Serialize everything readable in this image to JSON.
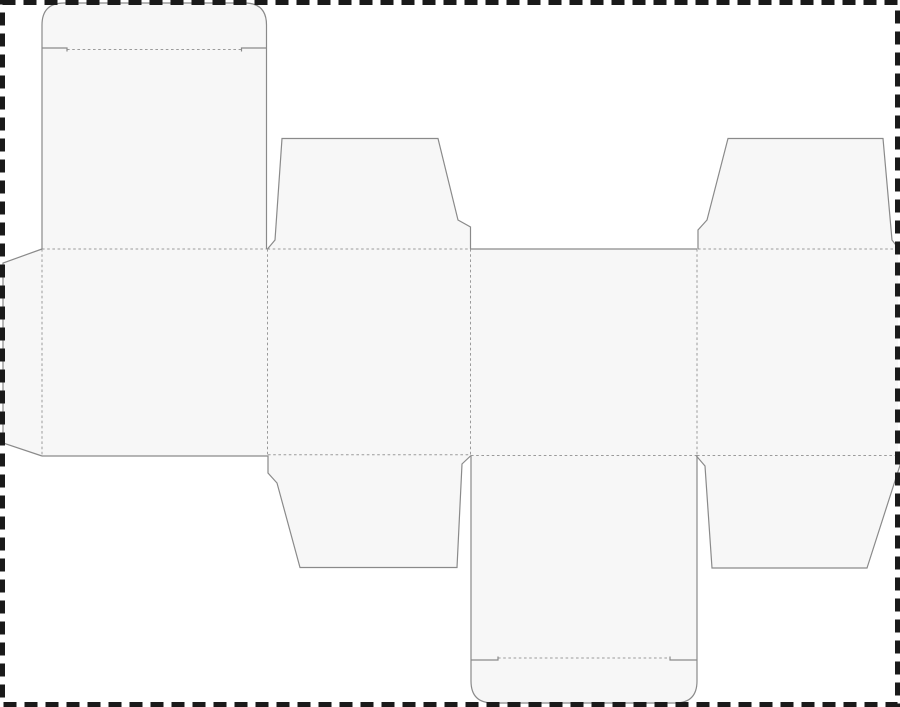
{
  "page": {
    "title": "box-dieline-template",
    "description": "Die-cut template (net) for a tuck-top carton: glue tab, four body panels, lid panel with rounded tuck flap, four dust flaps, bottom panel with rounded tuck flap. No text content."
  },
  "drawing": {
    "width": 900,
    "height": 707,
    "colors": {
      "background": "#ffffff",
      "panel_fill": "#f7f7f7",
      "cut_line": "#8a8a8a",
      "fold_line": "#9b9b9b",
      "page_border": "#1a1a1a"
    },
    "stroke_widths": {
      "cut": 1.2,
      "fold": 1,
      "border": 5
    },
    "fold_dash": "2.6 2.6",
    "page_border": {
      "x": 2.5,
      "y": 2.5,
      "width": 895,
      "height": 702,
      "dash": "13 8"
    },
    "fills": [
      {
        "name": "lid-panel-and-tuck-fill",
        "d": "M42,249 L42,25 Q42,3 64,3 L244.5,3 Q266.5,3 266.5,25 L266.5,249 Z"
      },
      {
        "name": "glue-tab-fill",
        "d": "M42,249 L3,263 L3,443 L42,456 Z"
      },
      {
        "name": "body-panels-band-fill",
        "d": "M42,249 L898,249 L898,456 L42,456 Z"
      },
      {
        "name": "top-dust-flap-left-fill",
        "d": "M267.5,249 L275,240 L282,138.5 L438,138.5 L458,220 L470.5,227 L470.5,249 Z"
      },
      {
        "name": "top-dust-flap-right-fill",
        "d": "M698,249 L698,230 L707,220 L728,138.5 L883,138.5 L892,240 L899,249 Z"
      },
      {
        "name": "bottom-dust-flap-left-fill",
        "d": "M268,455.5 L268,473 L277,483 L300,567.5 L457,567.5 L462,464 L471,455.5 Z"
      },
      {
        "name": "bottom-dust-flap-right-fill",
        "d": "M696,455.5 L705,466 L712,568 L867,568 L903,456 Z"
      },
      {
        "name": "bottom-panel-and-tuck-fill",
        "d": "M471,455.5 L697,455.5 L697,681 Q697,703 675,703 L493,703 Q471,703 471,681 Z"
      }
    ],
    "cuts": [
      {
        "name": "lid-tuck-outline-cut",
        "d": "M42,48 L42,25 Q42,3 64,3 L244.5,3 Q266.5,3 266.5,25 L266.5,48"
      },
      {
        "name": "lid-tuck-shoulder-left-cut",
        "d": "M42,48 L67,48 L67,51.5"
      },
      {
        "name": "lid-tuck-shoulder-right-cut",
        "d": "M266.5,48 L241.5,48 L241.5,51.5"
      },
      {
        "name": "lid-panel-left-edge-cut",
        "d": "M42,48 L42,249"
      },
      {
        "name": "lid-panel-right-edge-cut",
        "d": "M266.5,48 L266.5,249"
      },
      {
        "name": "glue-tab-outline-cut",
        "d": "M42,249 L3,263 L3,443 L42,456"
      },
      {
        "name": "front-panel-bottom-edge-cut",
        "d": "M42,456 L268,456"
      },
      {
        "name": "top-dust-flap-left-outline-cut",
        "d": "M267.5,249 L275,240 L282,138.5 L438,138.5 L458,220 L470.5,227 L470.5,249"
      },
      {
        "name": "back-panel-top-edge-cut",
        "d": "M470.5,249 L697,249"
      },
      {
        "name": "top-dust-flap-right-outline-cut",
        "d": "M698,249 L698,230 L707,220 L728,138.5 L883,138.5 L892,240 L899,249"
      },
      {
        "name": "bottom-dust-flap-left-outline-cut",
        "d": "M268,455.5 L268,473 L277,483 L300,567.5 L457,567.5 L462,464 L471,455.5"
      },
      {
        "name": "bottom-dust-flap-right-outline-cut",
        "d": "M696,455.5 L705,466 L712,568 L867,568 L903,456"
      },
      {
        "name": "bottom-panel-left-edge-cut",
        "d": "M471,455.5 L471,660"
      },
      {
        "name": "bottom-panel-right-edge-cut",
        "d": "M697,455.5 L697,660"
      },
      {
        "name": "bottom-tuck-shoulder-left-cut",
        "d": "M471,660 L498,660 L498,656.5"
      },
      {
        "name": "bottom-tuck-shoulder-right-cut",
        "d": "M697,660 L670,660 L670,656.5"
      },
      {
        "name": "bottom-tuck-outline-cut",
        "d": "M471,660 L471,681 Q471,703 493,703 L675,703 Q697,703 697,681 L697,660"
      }
    ],
    "folds": [
      {
        "name": "lid-tuck-fold",
        "d": "M67,49.5 L241.5,49.5"
      },
      {
        "name": "lid-to-front-panel-fold",
        "d": "M42,249 L267.5,249"
      },
      {
        "name": "top-dust-flap-left-fold",
        "d": "M267.5,249 L470.5,249"
      },
      {
        "name": "top-dust-flap-right-fold",
        "d": "M698,249 L897,249"
      },
      {
        "name": "bottom-dust-flap-left-fold",
        "d": "M268,454.8 L471,454.8"
      },
      {
        "name": "back-panel-to-bottom-panel-fold",
        "d": "M471,455.5 L697,455.5"
      },
      {
        "name": "bottom-dust-flap-right-fold",
        "d": "M697,455.5 L897,455.5"
      },
      {
        "name": "glue-tab-fold",
        "d": "M42,249 L42,456"
      },
      {
        "name": "panel-1-2-fold",
        "d": "M267.5,249 L267.5,455"
      },
      {
        "name": "panel-2-3-fold",
        "d": "M470.5,249 L470.5,455"
      },
      {
        "name": "panel-3-4-fold",
        "d": "M697,249 L697,455.5"
      },
      {
        "name": "bottom-tuck-fold",
        "d": "M498,658 L670,658"
      }
    ]
  }
}
